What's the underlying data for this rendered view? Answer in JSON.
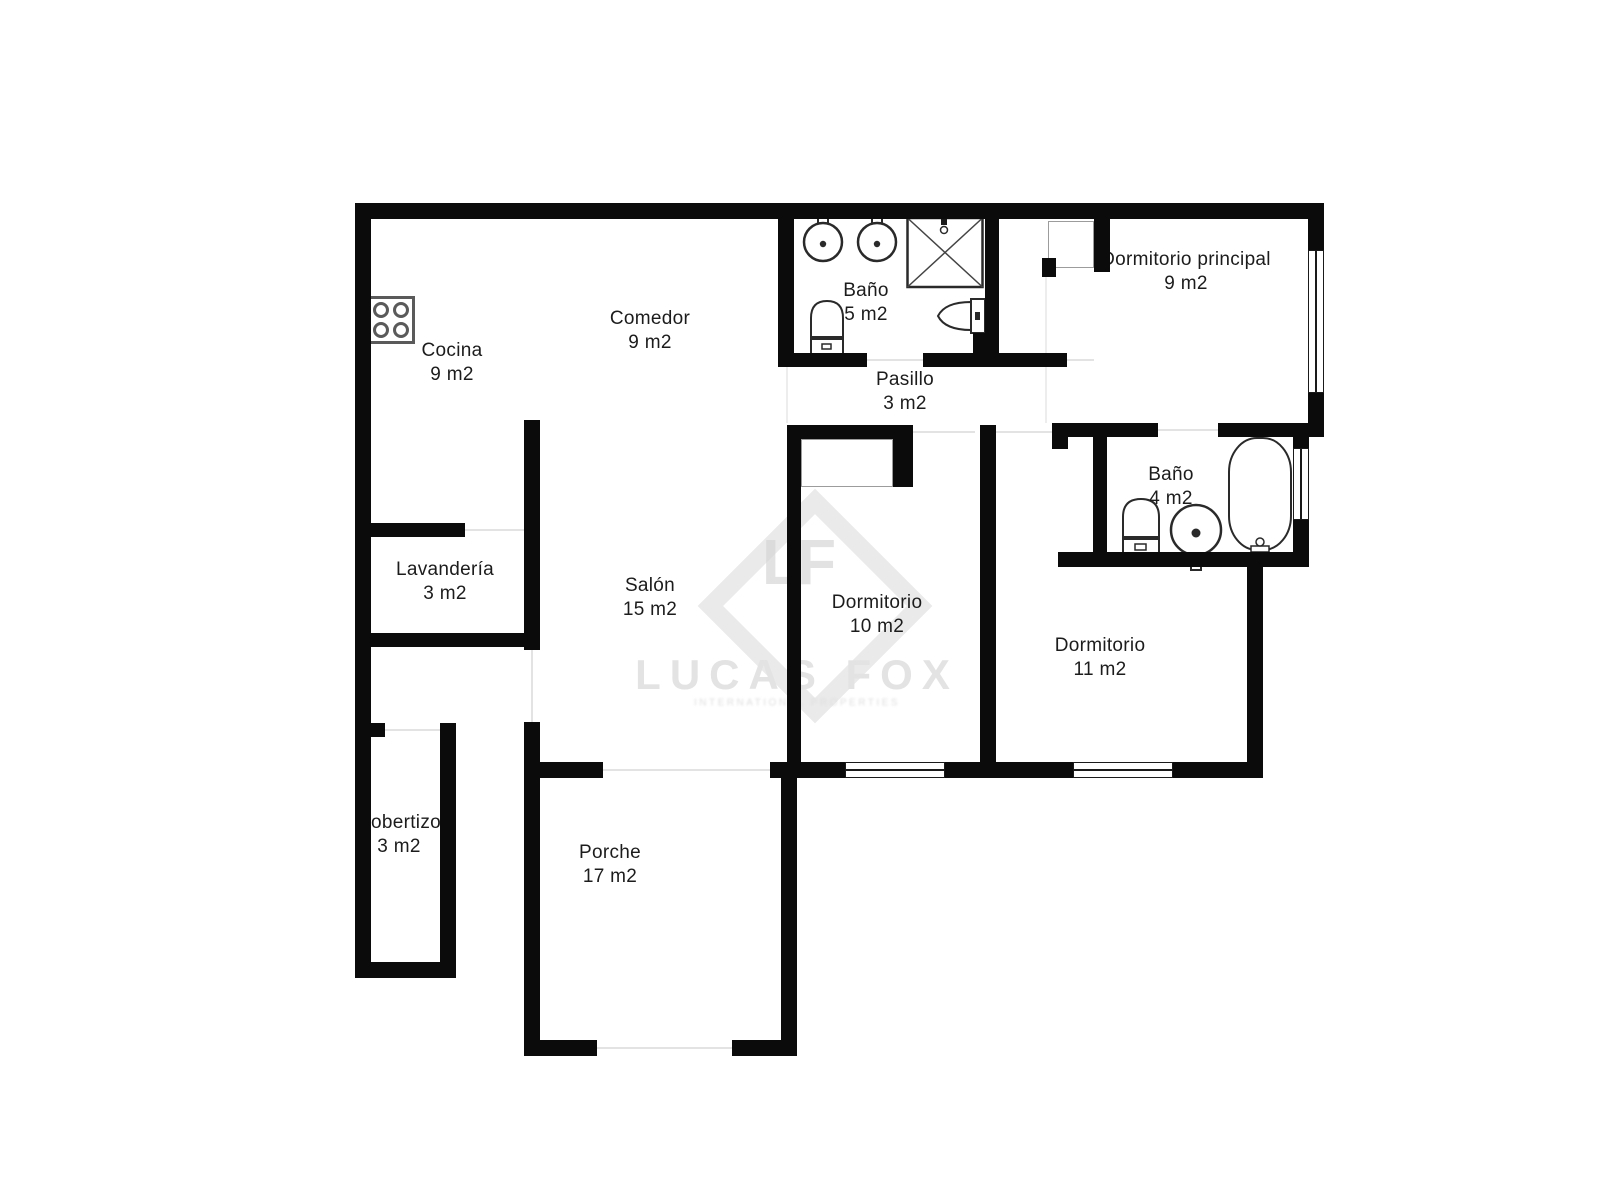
{
  "watermark": {
    "monogram": "LF",
    "brand": "LUCAS FOX",
    "tagline": "INTERNATIONAL PROPERTIES"
  },
  "rooms": [
    {
      "id": "cocina",
      "name": "Cocina",
      "area": "9 m2"
    },
    {
      "id": "comedor",
      "name": "Comedor",
      "area": "9 m2"
    },
    {
      "id": "bano-5",
      "name": "Baño",
      "area": "5 m2"
    },
    {
      "id": "pasillo",
      "name": "Pasillo",
      "area": "3 m2"
    },
    {
      "id": "dormitorio-principal",
      "name": "Dormitorio principal",
      "area": "9 m2"
    },
    {
      "id": "bano-4",
      "name": "Baño",
      "area": "4 m2"
    },
    {
      "id": "lavanderia",
      "name": "Lavandería",
      "area": "3 m2"
    },
    {
      "id": "salon",
      "name": "Salón",
      "area": "15 m2"
    },
    {
      "id": "dormitorio-10",
      "name": "Dormitorio",
      "area": "10 m2"
    },
    {
      "id": "dormitorio-11",
      "name": "Dormitorio",
      "area": "11 m2"
    },
    {
      "id": "cobertizo",
      "name": "Cobertizo",
      "area": "3 m2"
    },
    {
      "id": "porche",
      "name": "Porche",
      "area": "17 m2"
    }
  ]
}
